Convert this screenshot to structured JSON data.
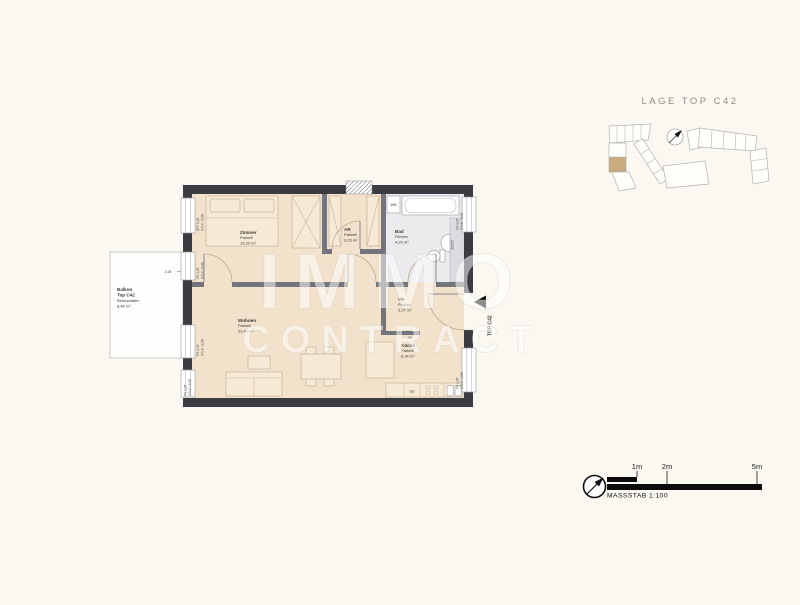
{
  "site_plan": {
    "title": "LAGE TOP C42",
    "highlight_color": "#c9ad7e"
  },
  "watermark": {
    "line1": "IMMO",
    "line2": "CONTRACT"
  },
  "scale_bar": {
    "tick_labels": [
      "1m",
      "2m",
      "5m"
    ],
    "caption": "MASSSTAB 1:100"
  },
  "plan": {
    "colors": {
      "wall": "#3b3b42",
      "floor_parkett": "#f2e2cb",
      "floor_tiles": "#ebebee"
    },
    "entrance_label": "TOP C42",
    "level_label": "-0,06",
    "door_size_label": "90/135",
    "rooms": {
      "zimmer": {
        "name": "Zimmer",
        "floor": "Parkett",
        "area": "13,20 m²"
      },
      "ar": {
        "name": "AR",
        "floor": "Parkett",
        "area": "3,23 m²"
      },
      "bad": {
        "name": "Bad",
        "floor": "Fliesen",
        "area": "4,29 m²"
      },
      "vr": {
        "name": "VR",
        "floor": "Parkett",
        "area": "3,27 m²"
      },
      "wohnen": {
        "name": "Wohnen",
        "floor": "Parkett",
        "area": "23,41 m²"
      },
      "kueche": {
        "name": "Küche",
        "floor": "Parkett",
        "area": "8,34 m²"
      },
      "balkon": {
        "name": "Balkon",
        "unit": "Top C42",
        "floor": "Betonplatten",
        "area": "8,46 m²"
      }
    },
    "fixtures": {
      "wm": "WM",
      "gs": "GS",
      "kb": "KB"
    },
    "window_labels": [
      {
        "l1": "DFF 0,90",
        "l2": "STLK +2,08"
      },
      {
        "l1": "FH 1,35",
        "l2": "STLK +0,40"
      },
      {
        "l1": "FH 1,35",
        "l2": "STLK +2,08"
      },
      {
        "l1": "FH 1,35",
        "l2": "STLK +2,08"
      },
      {
        "l1": "FH 1,35",
        "l2": "STLK +2,08"
      },
      {
        "l1": "FH 1,35",
        "l2": "STLK +2,08"
      }
    ]
  }
}
